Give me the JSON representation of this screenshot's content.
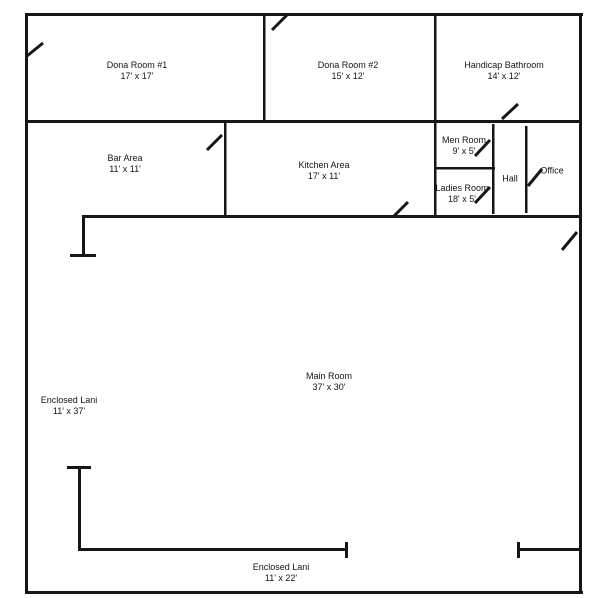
{
  "colors": {
    "wall": "#161616",
    "background": "#ffffff",
    "text": "#151515"
  },
  "rooms": {
    "dona1": {
      "name": "Dona Room #1",
      "size": "17' x 17'"
    },
    "dona2": {
      "name": "Dona Room #2",
      "size": "15' x 12'"
    },
    "handicap": {
      "name": "Handicap Bathroom",
      "size": "14' x 12'"
    },
    "bar": {
      "name": "Bar Area",
      "size": "11' x 11'"
    },
    "kitchen": {
      "name": "Kitchen Area",
      "size": "17' x 11'"
    },
    "men": {
      "name": "Men Room",
      "size": "9' x 5'"
    },
    "ladies": {
      "name": "Ladies Room",
      "size": "18' x 5'"
    },
    "hall": {
      "name": "Hall"
    },
    "office": {
      "name": "Office"
    },
    "main": {
      "name": "Main Room",
      "size": "37' x 30'"
    },
    "lani_left": {
      "name": "Enclosed Lani",
      "size": "11' x 37'"
    },
    "lani_bottom": {
      "name": "Enclosed Lani",
      "size": "11' x 22'"
    }
  }
}
